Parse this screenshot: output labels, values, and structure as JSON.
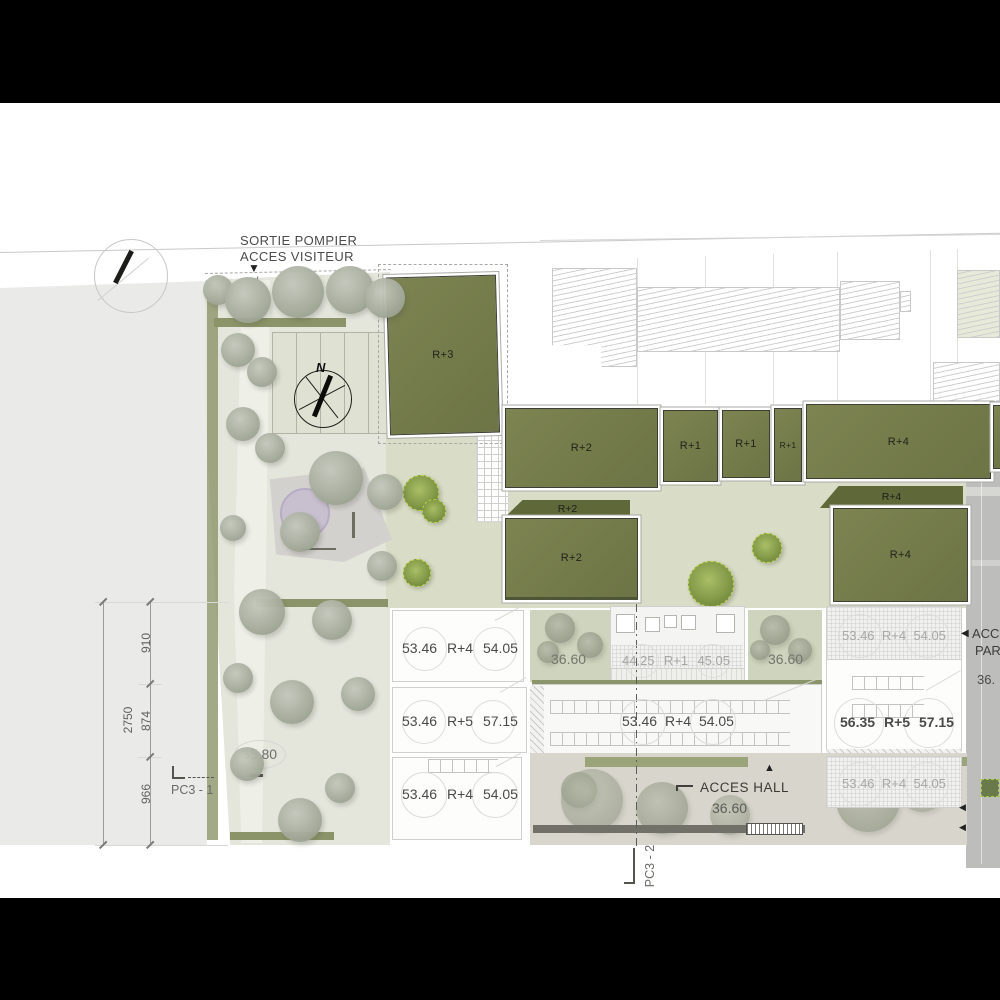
{
  "entrance": {
    "sortie_pompier": "SORTIE POMPIER",
    "acces_visiteur": "ACCES VISITEUR",
    "entry_arrow": "▼"
  },
  "compass": {
    "north": "N"
  },
  "buildings": {
    "r3": "R+3",
    "r2_top": "R+2",
    "r2_band": "R+2",
    "r2_low": "R+2",
    "r1_a": "R+1",
    "r1_b": "R+1",
    "r1_c": "R+1",
    "r4_top": "R+4",
    "r4_band": "R+4",
    "r4_low": "R+4"
  },
  "levels": {
    "row1_left": {
      "low": "53.46",
      "floors": "R+4",
      "high": "54.05"
    },
    "strip_mid": {
      "low": "44.25",
      "floors": "R+1",
      "high": "45.05"
    },
    "row1_right": {
      "low": "53.46",
      "floors": "R+4",
      "high": "54.05"
    },
    "row2_left": {
      "low": "53.46",
      "floors": "R+5",
      "high": "57.15"
    },
    "row2_mid": {
      "low": "53.46",
      "floors": "R+4",
      "high": "54.05"
    },
    "row2_right": {
      "low": "56.35",
      "floors": "R+5",
      "high": "57.15"
    },
    "row3_left": {
      "low": "53.46",
      "floors": "R+4",
      "high": "54.05"
    },
    "row3_right": {
      "low": "53.46",
      "floors": "R+4",
      "high": "54.05"
    }
  },
  "ground_levels": {
    "park": "35.80",
    "court_a": "36.60",
    "court_b": "36.60",
    "hall": "36.60"
  },
  "access": {
    "hall": "ACCES HALL",
    "hall_arrow": "▲"
  },
  "sections": {
    "pc3_1": "PC3 - 1",
    "pc3_2": "PC3 - 2"
  },
  "dimensions": {
    "seg_a": "910",
    "seg_b": "874",
    "seg_c": "966",
    "total": "2750"
  },
  "street_edge": {
    "arrow": "◀",
    "frag_line1": "ACC",
    "frag_line2": "PAR",
    "frag_line3": "36."
  },
  "colors": {
    "building_green": "#757c4b",
    "building_green_dark": "#5f6839",
    "courtyard_sage": "#d9dcc6",
    "park_base": "#e4e6dc",
    "street_gray": "#bdbdbb",
    "accent_tree": "#7c9440",
    "lilac": "#c7bdd0",
    "text_dark": "#3f3f3d",
    "text_gray": "#a7a7a3"
  }
}
